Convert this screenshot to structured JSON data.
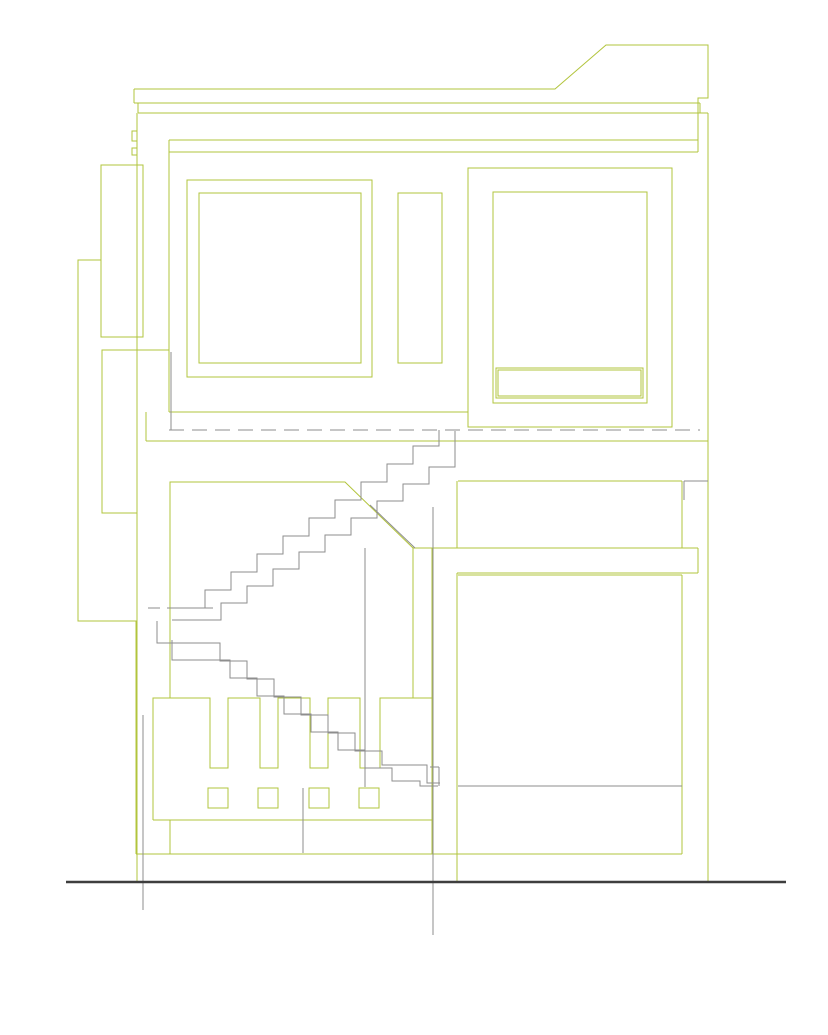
{
  "document": {
    "type": "architectural-elevation-section-drawing",
    "description": "CAD line drawing: two-storey house elevation/section with switchback staircase, windows, slotted base block and ground datum line",
    "canvas": {
      "width": 828,
      "height": 1035,
      "background": "#ffffff"
    }
  },
  "palette": {
    "outline_green": "#b2c43c",
    "section_gray": "#8e8e8e",
    "ground_dark": "#3e3e3e"
  },
  "geometry": {
    "green": {
      "segments": [
        [
          169,
          140,
          698,
          140
        ],
        [
          169,
          152,
          698,
          152
        ],
        [
          138,
          113,
          708,
          113
        ],
        [
          134,
          103,
          700,
          103
        ],
        [
          134,
          89,
          134,
          103
        ],
        [
          138,
          103,
          138,
          113
        ],
        [
          700,
          103,
          700,
          113
        ],
        [
          708,
          113,
          708,
          882
        ],
        [
          137,
          113,
          137,
          882
        ],
        [
          169,
          140,
          169,
          412
        ],
        [
          169,
          412,
          468,
          412
        ],
        [
          146,
          441,
          708,
          441
        ],
        [
          146,
          412,
          146,
          441
        ],
        [
          137,
          350,
          169,
          350
        ],
        [
          413,
          548,
          698,
          548
        ],
        [
          698,
          548,
          698,
          573
        ],
        [
          457,
          573,
          698,
          573
        ],
        [
          458,
          575,
          682,
          575
        ],
        [
          457,
          481,
          457,
          548
        ],
        [
          457,
          573,
          457,
          882
        ],
        [
          458,
          481,
          682,
          481
        ],
        [
          682,
          481,
          682,
          548
        ],
        [
          682,
          575,
          682,
          854
        ],
        [
          432,
          548,
          432,
          854
        ],
        [
          153,
          820,
          432,
          820
        ],
        [
          170,
          820,
          170,
          854
        ],
        [
          136,
          854,
          682,
          854
        ]
      ],
      "rects": [
        [
          101,
          165,
          42,
          172
        ],
        [
          102,
          350,
          35,
          163
        ],
        [
          187,
          180,
          185,
          197
        ],
        [
          199,
          193,
          162,
          170
        ],
        [
          398,
          193,
          44,
          170
        ],
        [
          468,
          168,
          204,
          259
        ],
        [
          493,
          192,
          154,
          211
        ],
        [
          496,
          368,
          147,
          30
        ],
        [
          498,
          370,
          143,
          26
        ],
        [
          208,
          788,
          20,
          20
        ],
        [
          258,
          788,
          20,
          20
        ],
        [
          309,
          788,
          20,
          20
        ],
        [
          359,
          788,
          20,
          20
        ]
      ],
      "polylines": [
        [
          [
            134,
            89
          ],
          [
            555,
            89
          ],
          [
            606,
            45
          ],
          [
            708,
            45
          ],
          [
            708,
            98
          ],
          [
            698,
            98
          ],
          [
            698,
            152
          ]
        ],
        [
          [
            137,
            131
          ],
          [
            132,
            131
          ],
          [
            132,
            141
          ],
          [
            137,
            141
          ]
        ],
        [
          [
            137,
            148
          ],
          [
            132,
            148
          ],
          [
            132,
            155
          ],
          [
            137,
            155
          ]
        ],
        [
          [
            101,
            260
          ],
          [
            78,
            260
          ],
          [
            78,
            621
          ],
          [
            136,
            621
          ],
          [
            136,
            854
          ]
        ],
        [
          [
            170,
            698
          ],
          [
            170,
            482
          ],
          [
            345,
            482
          ],
          [
            413,
            548
          ],
          [
            413,
            698
          ]
        ],
        [
          [
            153,
            820
          ],
          [
            153,
            698
          ],
          [
            210,
            698
          ],
          [
            210,
            768
          ],
          [
            228,
            768
          ],
          [
            228,
            698
          ],
          [
            260,
            698
          ],
          [
            260,
            768
          ],
          [
            278,
            768
          ],
          [
            278,
            698
          ],
          [
            310,
            698
          ],
          [
            310,
            768
          ],
          [
            328,
            768
          ],
          [
            328,
            698
          ],
          [
            360,
            698
          ],
          [
            360,
            768
          ],
          [
            380,
            768
          ],
          [
            380,
            698
          ],
          [
            432,
            698
          ]
        ]
      ]
    },
    "gray": {
      "segments": [
        [
          433,
          507,
          433,
          935
        ],
        [
          143,
          715,
          143,
          910
        ],
        [
          365,
          548,
          365,
          787
        ],
        [
          303,
          788,
          303,
          853
        ],
        [
          370,
          505,
          415,
          548
        ],
        [
          684,
          481,
          708,
          481
        ],
        [
          684,
          481,
          684,
          500
        ],
        [
          171,
          352,
          171,
          430
        ],
        [
          458,
          786,
          682,
          786
        ],
        [
          439,
          767,
          439,
          786
        ],
        [
          430,
          767,
          439,
          767
        ]
      ],
      "stair_polylines": [
        [
          [
            439,
            430
          ],
          [
            439,
            446
          ],
          [
            413,
            446
          ],
          [
            413,
            464
          ],
          [
            387,
            464
          ],
          [
            387,
            482
          ],
          [
            361,
            482
          ],
          [
            361,
            500
          ],
          [
            335,
            500
          ],
          [
            335,
            518
          ],
          [
            309,
            518
          ],
          [
            309,
            536
          ],
          [
            283,
            536
          ],
          [
            283,
            554
          ],
          [
            257,
            554
          ],
          [
            257,
            572
          ],
          [
            231,
            572
          ],
          [
            231,
            590
          ],
          [
            205,
            590
          ],
          [
            205,
            608
          ],
          [
            179,
            608
          ]
        ],
        [
          [
            455,
            431
          ],
          [
            455,
            467
          ],
          [
            429,
            467
          ],
          [
            429,
            484
          ],
          [
            403,
            484
          ],
          [
            403,
            501
          ],
          [
            377,
            501
          ],
          [
            377,
            518
          ],
          [
            351,
            518
          ],
          [
            351,
            535
          ],
          [
            325,
            535
          ],
          [
            325,
            552
          ],
          [
            299,
            552
          ],
          [
            299,
            569
          ],
          [
            273,
            569
          ],
          [
            273,
            586
          ],
          [
            247,
            586
          ],
          [
            247,
            603
          ],
          [
            221,
            603
          ],
          [
            221,
            620
          ],
          [
            172,
            620
          ]
        ],
        [
          [
            157,
            621
          ],
          [
            157,
            643
          ],
          [
            220,
            643
          ],
          [
            220,
            661
          ],
          [
            247,
            661
          ],
          [
            247,
            679
          ],
          [
            274,
            679
          ],
          [
            274,
            697
          ],
          [
            301,
            697
          ],
          [
            301,
            715
          ],
          [
            328,
            715
          ],
          [
            328,
            733
          ],
          [
            355,
            733
          ],
          [
            355,
            751
          ],
          [
            382,
            751
          ],
          [
            382,
            765
          ],
          [
            427,
            765
          ],
          [
            427,
            783
          ],
          [
            440,
            783
          ]
        ],
        [
          [
            172,
            640
          ],
          [
            172,
            660
          ],
          [
            230,
            660
          ],
          [
            230,
            678
          ],
          [
            257,
            678
          ],
          [
            257,
            696
          ],
          [
            284,
            696
          ],
          [
            284,
            714
          ],
          [
            311,
            714
          ],
          [
            311,
            732
          ],
          [
            338,
            732
          ],
          [
            338,
            750
          ],
          [
            365,
            750
          ],
          [
            365,
            768
          ],
          [
            392,
            768
          ],
          [
            392,
            781
          ],
          [
            420,
            781
          ],
          [
            420,
            786
          ],
          [
            438,
            786
          ]
        ]
      ]
    },
    "dashed": [
      {
        "x1": 169,
        "y1": 430,
        "x2": 700,
        "y2": 430,
        "dash": [
          15,
          8
        ]
      },
      {
        "x1": 148,
        "y1": 608,
        "x2": 213,
        "y2": 608,
        "dash": [
          12,
          7
        ]
      }
    ],
    "ground": [
      66,
      882,
      786,
      882
    ]
  }
}
